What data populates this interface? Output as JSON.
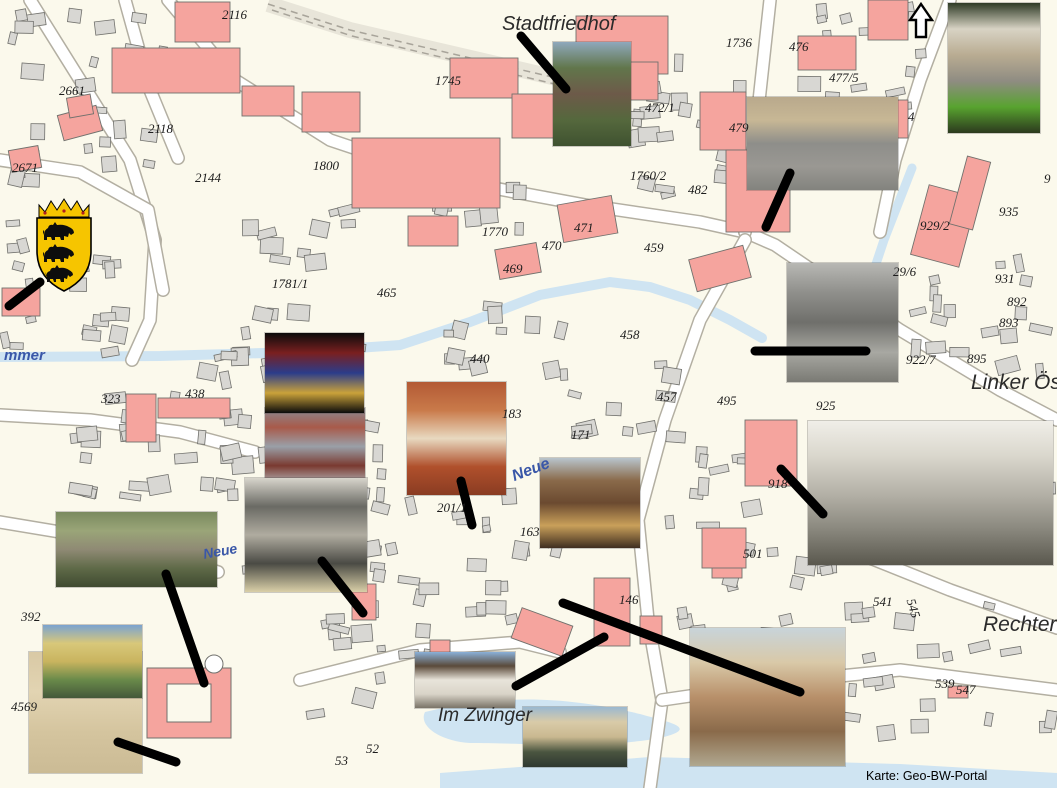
{
  "map": {
    "credit": "Karte: Geo-BW-Portal",
    "parcel_labels": [
      {
        "t": "2116",
        "x": 222,
        "y": 8
      },
      {
        "t": "2661",
        "x": 59,
        "y": 84
      },
      {
        "t": "2671",
        "x": 12,
        "y": 161
      },
      {
        "t": "2118",
        "x": 148,
        "y": 122
      },
      {
        "t": "2144",
        "x": 195,
        "y": 171
      },
      {
        "t": "1800",
        "x": 313,
        "y": 159
      },
      {
        "t": "1745",
        "x": 435,
        "y": 74
      },
      {
        "t": "1736",
        "x": 726,
        "y": 36
      },
      {
        "t": "476",
        "x": 789,
        "y": 40
      },
      {
        "t": "477/5",
        "x": 829,
        "y": 71
      },
      {
        "t": "479",
        "x": 729,
        "y": 121
      },
      {
        "t": "4",
        "x": 908,
        "y": 110
      },
      {
        "t": "472/1",
        "x": 645,
        "y": 101
      },
      {
        "t": "1760/2",
        "x": 630,
        "y": 169
      },
      {
        "t": "482",
        "x": 688,
        "y": 183
      },
      {
        "t": "1770",
        "x": 482,
        "y": 225
      },
      {
        "t": "471",
        "x": 574,
        "y": 221
      },
      {
        "t": "470",
        "x": 542,
        "y": 239
      },
      {
        "t": "469",
        "x": 503,
        "y": 262
      },
      {
        "t": "1781/1",
        "x": 272,
        "y": 277
      },
      {
        "t": "465",
        "x": 377,
        "y": 286
      },
      {
        "t": "459",
        "x": 644,
        "y": 241
      },
      {
        "t": "458",
        "x": 620,
        "y": 328
      },
      {
        "t": "440",
        "x": 470,
        "y": 352
      },
      {
        "t": "935",
        "x": 999,
        "y": 205
      },
      {
        "t": "929/2",
        "x": 920,
        "y": 219
      },
      {
        "t": "9",
        "x": 1044,
        "y": 172
      },
      {
        "t": "29/6",
        "x": 893,
        "y": 265
      },
      {
        "t": "931",
        "x": 995,
        "y": 272
      },
      {
        "t": "892",
        "x": 1007,
        "y": 295
      },
      {
        "t": "893",
        "x": 999,
        "y": 316
      },
      {
        "t": "922/7",
        "x": 906,
        "y": 353
      },
      {
        "t": "895",
        "x": 967,
        "y": 352
      },
      {
        "t": "925",
        "x": 816,
        "y": 399
      },
      {
        "t": "457",
        "x": 657,
        "y": 390
      },
      {
        "t": "495",
        "x": 717,
        "y": 394
      },
      {
        "t": "918",
        "x": 768,
        "y": 477
      },
      {
        "t": "501",
        "x": 743,
        "y": 547
      },
      {
        "t": "183",
        "x": 502,
        "y": 407
      },
      {
        "t": "171",
        "x": 571,
        "y": 428
      },
      {
        "t": "163",
        "x": 520,
        "y": 525
      },
      {
        "t": "201/1",
        "x": 437,
        "y": 501
      },
      {
        "t": "146",
        "x": 619,
        "y": 593
      },
      {
        "t": "323",
        "x": 101,
        "y": 392
      },
      {
        "t": "438",
        "x": 185,
        "y": 387
      },
      {
        "t": "392",
        "x": 21,
        "y": 610
      },
      {
        "t": "4569",
        "x": 11,
        "y": 700
      },
      {
        "t": "541",
        "x": 873,
        "y": 595
      },
      {
        "t": "545",
        "x": 917,
        "y": 597,
        "r": 73
      },
      {
        "t": "539",
        "x": 935,
        "y": 677
      },
      {
        "t": "547",
        "x": 956,
        "y": 683
      },
      {
        "t": "52",
        "x": 366,
        "y": 742
      },
      {
        "t": "53",
        "x": 335,
        "y": 754
      }
    ],
    "place_labels": [
      {
        "t": "Stadtfriedhof",
        "x": 502,
        "y": 14,
        "s": 20,
        "cls": "place"
      },
      {
        "t": "Linker Öster",
        "x": 971,
        "y": 372,
        "s": 21,
        "cls": "place"
      },
      {
        "t": "Rechter Ös",
        "x": 983,
        "y": 614,
        "s": 21,
        "cls": "place"
      },
      {
        "t": "Im Zwinger",
        "x": 438,
        "y": 706,
        "s": 19,
        "cls": "place"
      },
      {
        "t": "mmer",
        "x": 4,
        "y": 348,
        "s": 15,
        "cls": "street-blue"
      },
      {
        "t": "Neue",
        "x": 510,
        "y": 470,
        "s": 16,
        "cls": "street-blue",
        "r": -21
      },
      {
        "t": "Neue",
        "x": 202,
        "y": 547,
        "s": 14,
        "cls": "street-blue",
        "r": -10
      }
    ]
  },
  "compass": {
    "name": "north-arrow"
  },
  "crest": {
    "name": "baden-wuerttemberg-coat-of-arms",
    "shield_color": "#F6C500",
    "lion_color": "#0d0d0d",
    "outline_color": "#000000"
  },
  "colors": {
    "map_background": "#FBF9EC",
    "building_gray": "#D8D7D3",
    "building_pink": "#F5A49E",
    "building_stroke": "#71716d",
    "water": "#CFE4F2",
    "road_fill": "#FFFFFF",
    "road_casing": "#B3AFA2",
    "connector_line": "#000000"
  },
  "photos": [
    {
      "name": "floor-plan-drawing",
      "x": 29,
      "y": 652,
      "w": 113,
      "h": 121,
      "palette": [
        "#d9c9a5",
        "#e2d4b2",
        "#d4c49e",
        "#cbbb95"
      ]
    },
    {
      "name": "yellow-manor-house",
      "x": 43,
      "y": 625,
      "w": 99,
      "h": 73,
      "palette": [
        "#7aa3d0",
        "#d8c87a",
        "#c9b45f",
        "#6a8a4a",
        "#44583a"
      ]
    },
    {
      "name": "castle-gate-hohentuebingen",
      "x": 56,
      "y": 512,
      "w": 161,
      "h": 75,
      "palette": [
        "#7a8a5f",
        "#9aa578",
        "#8f8a74",
        "#5f6a48",
        "#3f4a30"
      ]
    },
    {
      "name": "rathaus-facade",
      "x": 265,
      "y": 408,
      "w": 100,
      "h": 77,
      "palette": [
        "#8a8a92",
        "#a85a4a",
        "#9aa0a8",
        "#7a3a30",
        "#b8bcc0"
      ]
    },
    {
      "name": "engraving-historic-scene",
      "x": 245,
      "y": 478,
      "w": 122,
      "h": 114,
      "palette": [
        "#d8d5cc",
        "#6a6a64",
        "#b0aca0",
        "#4a4a44",
        "#d9cfa8"
      ]
    },
    {
      "name": "stained-glass-window",
      "x": 265,
      "y": 333,
      "w": 99,
      "h": 80,
      "palette": [
        "#0b0b0b",
        "#7a1f1f",
        "#2b3c8a",
        "#caa23a",
        "#0b0b0b"
      ]
    },
    {
      "name": "rooftops-aerial",
      "x": 407,
      "y": 382,
      "w": 99,
      "h": 113,
      "palette": [
        "#b35a35",
        "#c97a4a",
        "#e8d9c0",
        "#b0502c",
        "#8a3c22"
      ]
    },
    {
      "name": "half-timbered-lane",
      "x": 540,
      "y": 458,
      "w": 100,
      "h": 90,
      "palette": [
        "#b8c4cc",
        "#8a6a4a",
        "#6b4a30",
        "#c9a05a",
        "#3f2e20"
      ]
    },
    {
      "name": "stadtfriedhof-grave-monument",
      "x": 553,
      "y": 42,
      "w": 78,
      "h": 104,
      "palette": [
        "#8fa8bc",
        "#61764b",
        "#6d5a49",
        "#55683d",
        "#3f5230"
      ]
    },
    {
      "name": "fountain-square",
      "x": 747,
      "y": 97,
      "w": 151,
      "h": 93,
      "palette": [
        "#b9a98c",
        "#c7b795",
        "#8e8e8a",
        "#9a9893",
        "#83837e"
      ]
    },
    {
      "name": "bebenhausen-monastery",
      "x": 948,
      "y": 3,
      "w": 92,
      "h": 130,
      "palette": [
        "#2f3b26",
        "#d8d3c4",
        "#b9ac92",
        "#8f8c82",
        "#58a32f",
        "#2c3a1e"
      ]
    },
    {
      "name": "street-historic-bw",
      "x": 787,
      "y": 263,
      "w": 111,
      "h": 119,
      "palette": [
        "#b8b8b4",
        "#8f8f8b",
        "#6f6f6b",
        "#a8a8a2",
        "#7a7a74"
      ]
    },
    {
      "name": "schloss-engraving",
      "x": 808,
      "y": 421,
      "w": 245,
      "h": 144,
      "palette": [
        "#f0eee8",
        "#d9d6cc",
        "#b5b2a8",
        "#8a887e",
        "#5a584e"
      ]
    },
    {
      "name": "im-zwinger-house",
      "x": 415,
      "y": 652,
      "w": 100,
      "h": 56,
      "palette": [
        "#8ab0d8",
        "#5a4a3a",
        "#e8e4da",
        "#d9d4c8",
        "#7a7468"
      ]
    },
    {
      "name": "neckarfront-houses",
      "x": 523,
      "y": 707,
      "w": 104,
      "h": 60,
      "palette": [
        "#9ab8d0",
        "#d9cba8",
        "#c9b890",
        "#4a5540",
        "#2f3830"
      ]
    },
    {
      "name": "postcard-street",
      "x": 690,
      "y": 628,
      "w": 155,
      "h": 138,
      "palette": [
        "#c8d4da",
        "#d9c9a8",
        "#b8906a",
        "#8a6a4a",
        "#b0a890"
      ]
    }
  ],
  "connector_lines": [
    {
      "x1": 521,
      "y1": 36,
      "x2": 566,
      "y2": 89
    },
    {
      "x1": 790,
      "y1": 173,
      "x2": 766,
      "y2": 227
    },
    {
      "x1": 755,
      "y1": 351,
      "x2": 866,
      "y2": 351
    },
    {
      "x1": 40,
      "y1": 282,
      "x2": 9,
      "y2": 306
    },
    {
      "x1": 461,
      "y1": 481,
      "x2": 472,
      "y2": 525
    },
    {
      "x1": 322,
      "y1": 561,
      "x2": 363,
      "y2": 613
    },
    {
      "x1": 166,
      "y1": 574,
      "x2": 204,
      "y2": 683
    },
    {
      "x1": 118,
      "y1": 742,
      "x2": 176,
      "y2": 762
    },
    {
      "x1": 516,
      "y1": 686,
      "x2": 604,
      "y2": 637
    },
    {
      "x1": 563,
      "y1": 603,
      "x2": 800,
      "y2": 692
    },
    {
      "x1": 781,
      "y1": 469,
      "x2": 823,
      "y2": 514
    }
  ]
}
